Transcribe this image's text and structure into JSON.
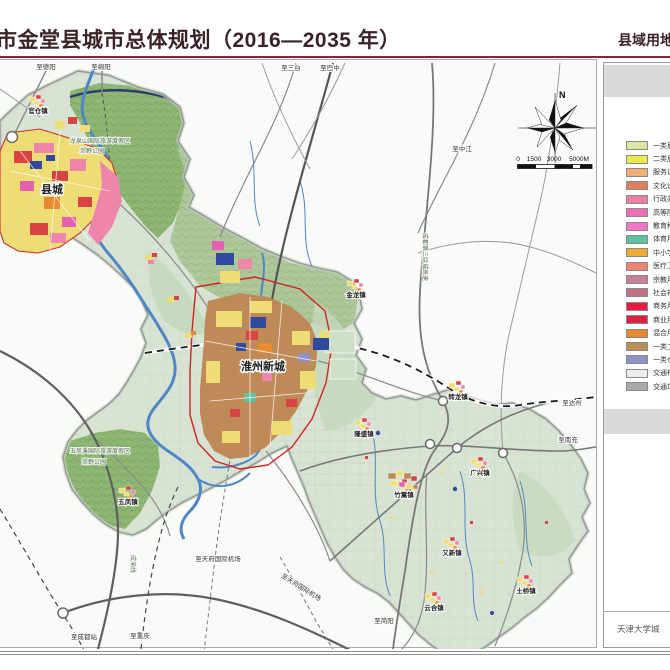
{
  "header": {
    "title": "市金堂县城市总体规划（2016—2035 年）",
    "right_title": "县域用地",
    "accent_color": "#8a2433"
  },
  "map": {
    "compass_n": "N",
    "scale_labels": [
      {
        "t": "0",
        "x": 518
      },
      {
        "t": "1500",
        "x": 534
      },
      {
        "t": "3000",
        "x": 554
      },
      {
        "t": "5000M",
        "x": 579
      }
    ],
    "city_labels": [
      {
        "t": "县城",
        "x": 52,
        "y": 192
      },
      {
        "t": "淮州新城",
        "x": 263,
        "y": 369
      }
    ],
    "towns": [
      {
        "name": "官仓镇",
        "x": 38,
        "y": 112
      },
      {
        "name": "金龙镇",
        "x": 356,
        "y": 296
      },
      {
        "name": "转龙镇",
        "x": 458,
        "y": 398
      },
      {
        "name": "隆盛镇",
        "x": 364,
        "y": 435
      },
      {
        "name": "竹篙镇",
        "x": 404,
        "y": 496,
        "big": true
      },
      {
        "name": "广兴镇",
        "x": 480,
        "y": 474
      },
      {
        "name": "又新镇",
        "x": 452,
        "y": 554
      },
      {
        "name": "云合镇",
        "x": 434,
        "y": 609
      },
      {
        "name": "土桥镇",
        "x": 526,
        "y": 592
      },
      {
        "name": "五凤镇",
        "x": 128,
        "y": 503
      }
    ],
    "road_labels": [
      {
        "t": "至德阳",
        "x": 46,
        "y": 68
      },
      {
        "t": "至绵阳",
        "x": 101,
        "y": 68
      },
      {
        "t": "至三台",
        "x": 291,
        "y": 69
      },
      {
        "t": "至巴中",
        "x": 330,
        "y": 69
      },
      {
        "t": "至中江",
        "x": 462,
        "y": 150
      },
      {
        "t": "至达州",
        "x": 572,
        "y": 404
      },
      {
        "t": "至南充",
        "x": 568,
        "y": 441
      },
      {
        "t": "至简阳",
        "x": 384,
        "y": 622
      },
      {
        "t": "至成都站",
        "x": 84,
        "y": 638
      },
      {
        "t": "至重庆",
        "x": 140,
        "y": 637
      },
      {
        "t": "至天府国际机场",
        "x": 218,
        "y": 560
      },
      {
        "t": "至天府国际机场",
        "x": 300,
        "y": 588,
        "rot": 32
      }
    ],
    "area_labels": [
      {
        "t": "龙泉山国际旅游度假区",
        "x": 100,
        "y": 142
      },
      {
        "t": "郊野公园",
        "x": 92,
        "y": 152
      },
      {
        "t": "五凤溪国际旅游度假区",
        "x": 100,
        "y": 452
      },
      {
        "t": "郊野公园",
        "x": 94,
        "y": 463
      },
      {
        "t": "成都第三绕城高速",
        "x": 423,
        "y": 256,
        "vert": true
      },
      {
        "t": "成渝线",
        "x": 131,
        "y": 563,
        "vert": true
      }
    ]
  },
  "legend": {
    "items": [
      {
        "label": "一类居",
        "color": "#dbe8a4"
      },
      {
        "label": "二类居",
        "color": "#e9e94d"
      },
      {
        "label": "服务设",
        "color": "#f2b078"
      },
      {
        "label": "文化设",
        "color": "#dd7f5c"
      },
      {
        "label": "行政办",
        "color": "#ee7da4"
      },
      {
        "label": "高等院",
        "color": "#f06fb3"
      },
      {
        "label": "教育科",
        "color": "#f376c6"
      },
      {
        "label": "体育用",
        "color": "#5fc2a0"
      },
      {
        "label": "中小学",
        "color": "#eeab31"
      },
      {
        "label": "医疗卫",
        "color": "#ef8573"
      },
      {
        "label": "宗教用",
        "color": "#c97f96"
      },
      {
        "label": "社会福",
        "color": "#c56f85"
      },
      {
        "label": "商务用",
        "color": "#e71a42"
      },
      {
        "label": "商业用",
        "color": "#dc2143"
      },
      {
        "label": "混合用",
        "color": "#e58a31"
      },
      {
        "label": "一类工",
        "color": "#bb8e55"
      },
      {
        "label": "一类仓",
        "color": "#8e92c5"
      },
      {
        "label": "交通枢",
        "color": "#ececec"
      },
      {
        "label": "交通场",
        "color": "#a9a9a9"
      }
    ]
  },
  "footer": {
    "credit": "天津大学城"
  }
}
